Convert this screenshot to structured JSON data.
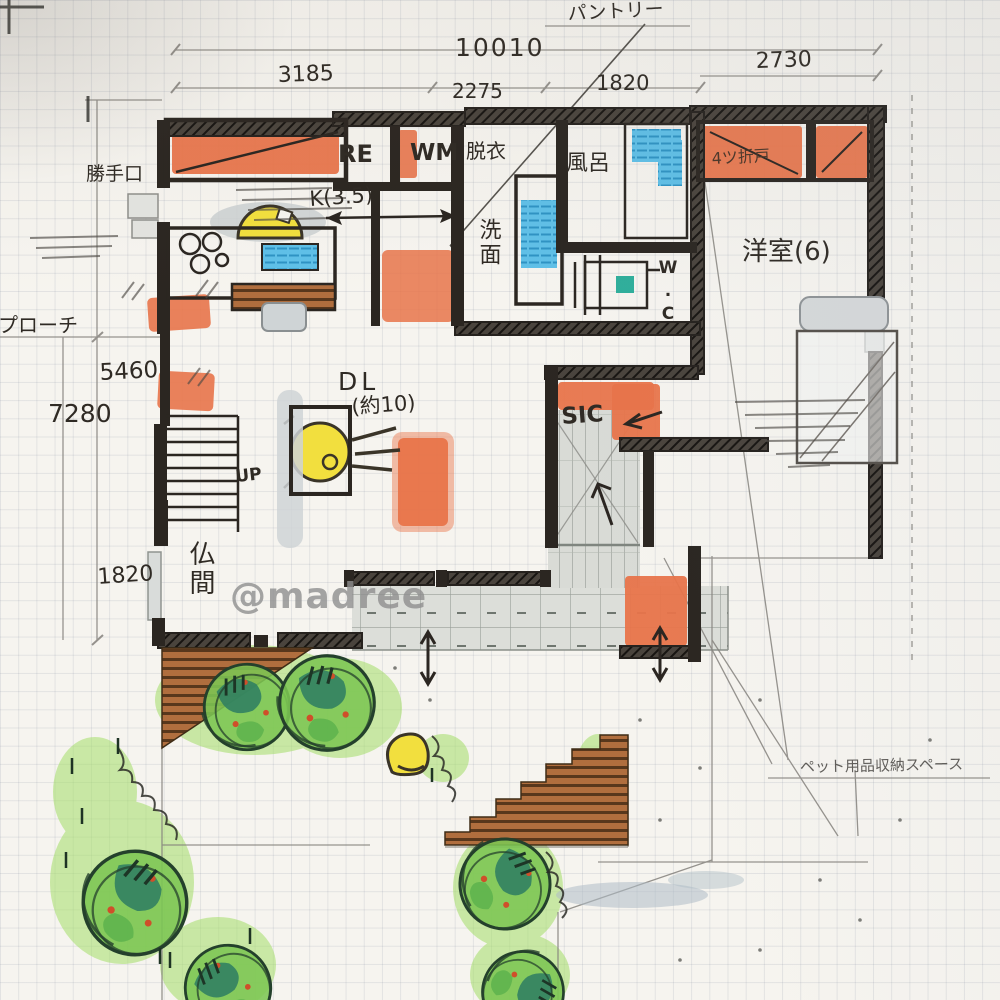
{
  "watermark": "@madree",
  "dimensions": {
    "total_width": "10010",
    "segments": [
      "3185",
      "2275",
      "1820",
      "2730"
    ],
    "left_height": "7280",
    "left_inner": "5460",
    "left_lower": "1820"
  },
  "rooms": {
    "kitchen": "K(3.5)",
    "dining_living": "DL",
    "dining_living_size": "(約10)",
    "western_room": "洋室(6)",
    "butsuma": "仏間",
    "bath": "風呂",
    "washroom": "洗面",
    "changing": "脱衣",
    "toilet": "W.C",
    "shoes_closet": "SIC"
  },
  "fixtures": {
    "fridge": "RE",
    "washing_machine": "WM",
    "stairs_up": "UP"
  },
  "annotations": {
    "pantry": "パントリー",
    "back_door": "勝手口",
    "approach": "アプローチ",
    "folding_door": "4ツ折戸",
    "pet_storage": "ペット用品収納スペース"
  },
  "colors": {
    "marker_orange": "#e8744a",
    "marker_blue": "#56bbe4",
    "marker_yellow": "#f2df3e",
    "marker_green": "#7cc653",
    "marker_teal_green": "#2d7d62",
    "marker_brown": "#a96a38",
    "ink": "#2b2621",
    "pencil": "#8a8a8a"
  }
}
